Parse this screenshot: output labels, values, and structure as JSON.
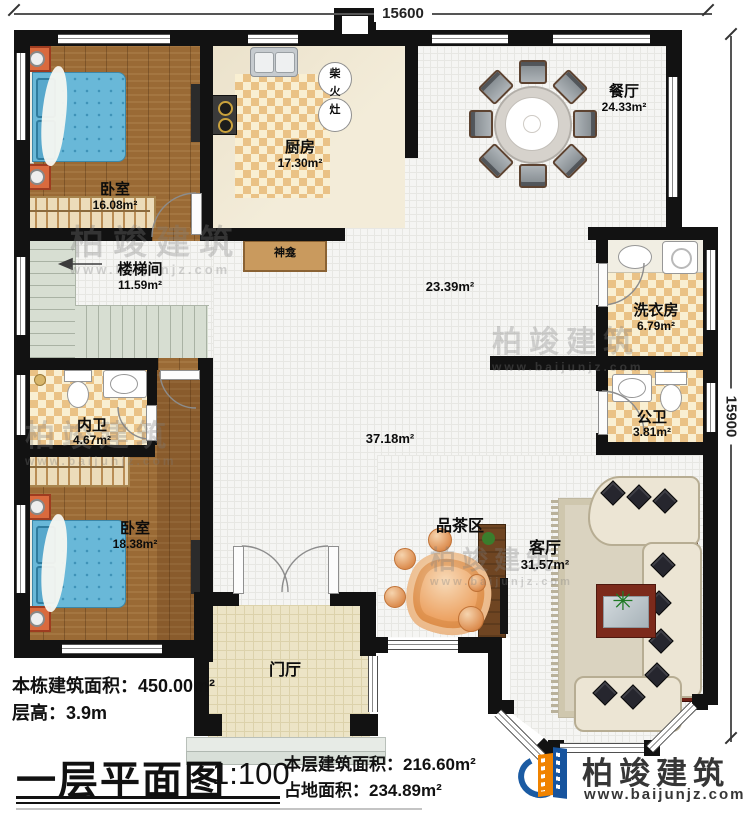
{
  "dimensions": {
    "top": "15600",
    "right": "15900"
  },
  "rooms": {
    "bedroom1": {
      "name": "卧室",
      "area": "16.08m²"
    },
    "kitchen": {
      "name": "厨房",
      "area": "17.30m²"
    },
    "dining": {
      "name": "餐厅",
      "area": "24.33m²"
    },
    "stairs": {
      "name": "楼梯间",
      "area": "11.59m²"
    },
    "hall_upper": {
      "area": "23.39m²"
    },
    "hall_lower": {
      "area": "37.18m²"
    },
    "laundry": {
      "name": "洗衣房",
      "area": "6.79m²"
    },
    "public_bath": {
      "name": "公卫",
      "area": "3.81m²"
    },
    "inner_bath": {
      "name": "内卫",
      "area": "4.67m²"
    },
    "bedroom2": {
      "name": "卧室",
      "area": "18.38m²"
    },
    "tea": {
      "name": "品茶区"
    },
    "living": {
      "name": "客厅",
      "area": "31.57m²"
    },
    "foyer": {
      "name": "门厅"
    },
    "shrine": {
      "name": "神龛"
    }
  },
  "stove": {
    "chars": [
      "柴",
      "火",
      "灶"
    ]
  },
  "footer": {
    "total_area": "本栋建筑面积：450.00m²",
    "floor_height": "层高：3.9m",
    "title": "一层平面图",
    "scale": "1:100",
    "floor_area": "本层建筑面积：216.60m²",
    "footprint": "占地面积：234.89m²"
  },
  "logo": {
    "name": "柏竣建筑",
    "url": "www.baijunjz.com"
  },
  "watermark": {
    "name": "柏竣建筑",
    "url": "www.baijunjz.com"
  }
}
